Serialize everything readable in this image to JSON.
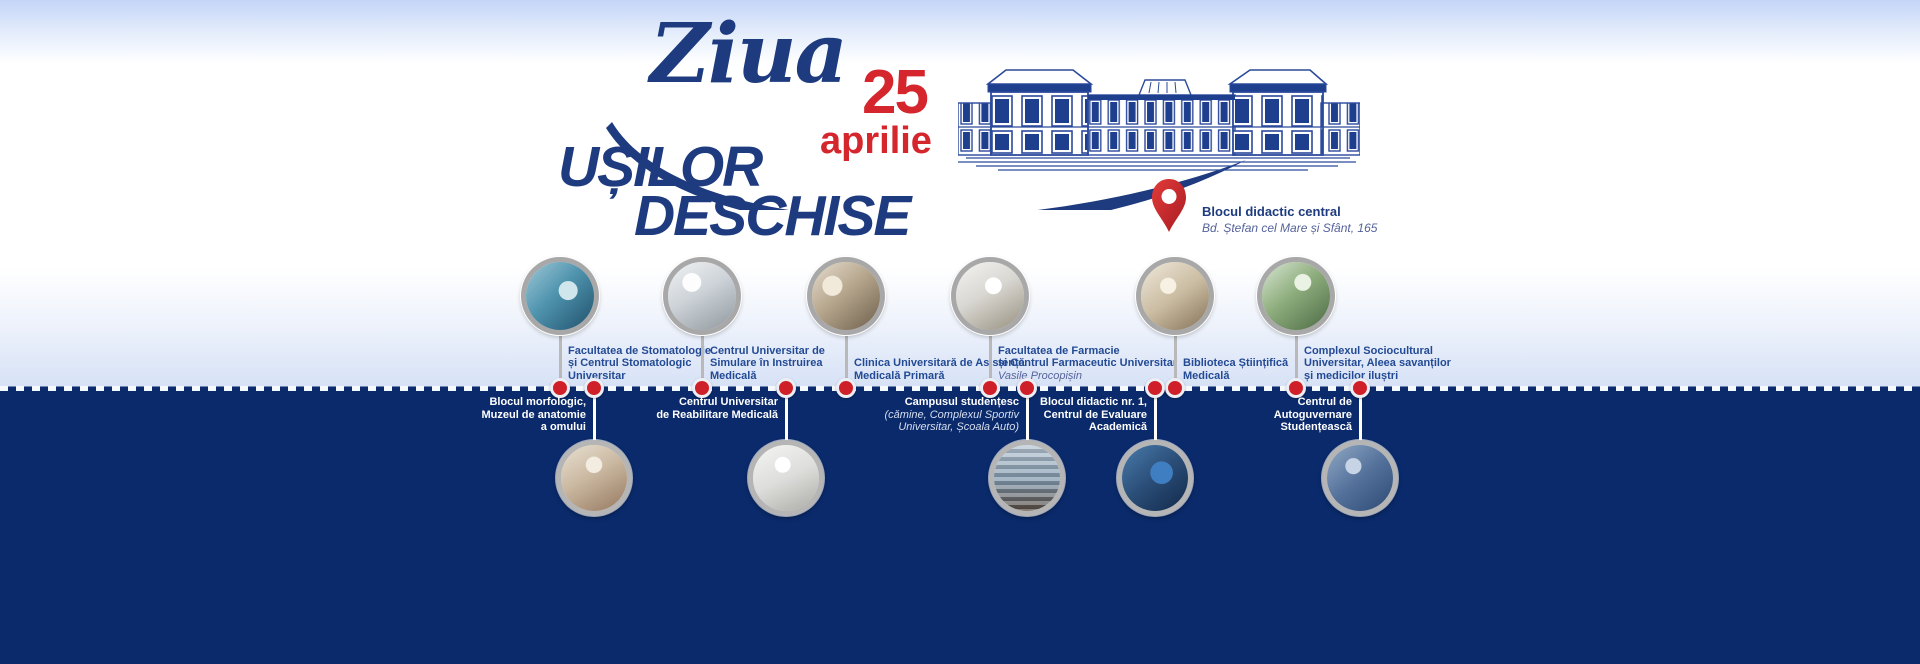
{
  "banner": {
    "title_script": "Ziua",
    "title_line1": "UȘILOR",
    "title_line2": "DESCHISE",
    "date": {
      "day": "25",
      "month": "aprilie"
    },
    "location": {
      "name": "Blocul didactic central",
      "address": "Bd. Ștefan cel Mare și Sfânt, 165"
    }
  },
  "icons": {
    "pin": "location-pin-icon",
    "building": "university-main-building-line-art",
    "swash": "calligraphic-swash"
  },
  "colors": {
    "navy_background": "#0a2a6b",
    "title_blue": "#1d3b7e",
    "accent_red": "#d4262c",
    "dot_red": "#cf1f28",
    "top_label_blue": "#234a94",
    "ring_gray": "#a8a8a8",
    "band_light_blue": "#d7e2f6",
    "top_gradient_blue": "#c3d5f7"
  },
  "timeline": {
    "top": [
      {
        "lines": [
          "Facultatea de Stomatologie",
          "și Centrul Stomatologic",
          "Universitar"
        ],
        "photo": "dental-clinic-photo"
      },
      {
        "lines": [
          "Centrul Universitar de",
          "Simulare în Instruirea",
          "Medicală"
        ],
        "photo": "medical-simulation-photo"
      },
      {
        "lines": [
          "Clinica Universitară de Asistență",
          "Medicală Primară"
        ],
        "photo": "primary-care-clinic-photo"
      },
      {
        "lines": [
          "Facultatea de Farmacie",
          "și Centrul Farmaceutic Universitar"
        ],
        "italic": "Vasile Procopișin",
        "photo": "pharmacy-photo"
      },
      {
        "lines": [
          "Biblioteca Științifică",
          "Medicală"
        ],
        "photo": "library-photo"
      },
      {
        "lines": [
          "Complexul Sociocultural",
          "Universitar, Aleea savanților",
          "și medicilor iluștri"
        ],
        "photo": "sociocultural-complex-photo"
      }
    ],
    "bottom": [
      {
        "lines": [
          "Blocul morfologic,",
          "Muzeul de anatomie",
          "a omului"
        ],
        "photo": "anatomy-museum-photo"
      },
      {
        "lines": [
          "Centrul Universitar",
          "de Reabilitare Medicală"
        ],
        "photo": "rehabilitation-center-photo"
      },
      {
        "lines": [
          "Campusul studențesc"
        ],
        "italic_lines": [
          "(cămine, Complexul Sportiv",
          "Universitar, Școala Auto)"
        ],
        "photo": "student-campus-photo"
      },
      {
        "lines": [
          "Blocul didactic nr. 1,",
          "Centrul de Evaluare",
          "Academică"
        ],
        "photo": "computer-lab-photo"
      },
      {
        "lines": [
          "Centrul de",
          "Autoguvernare",
          "Studențească"
        ],
        "photo": "student-government-photo"
      }
    ]
  }
}
